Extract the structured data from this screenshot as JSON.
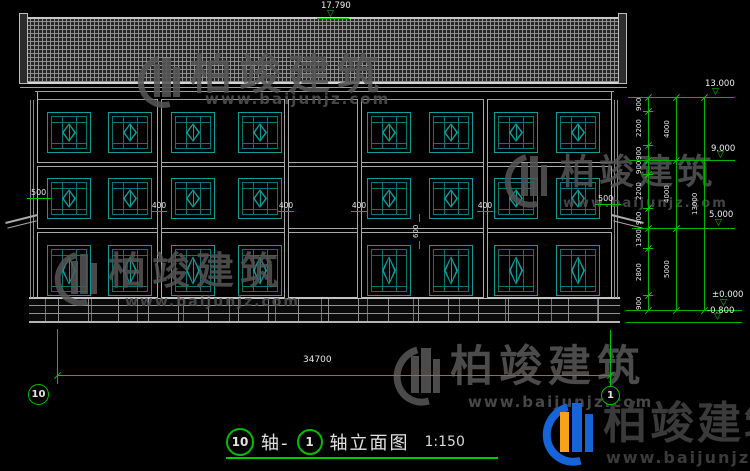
{
  "watermark": {
    "brand": "柏竣建筑",
    "url": "www.baijunjz.com"
  },
  "title": {
    "axis_start_bubble": "10",
    "axis_label_left": "轴-",
    "axis_end_bubble": "1",
    "drawing_name": "轴立面图",
    "scale": "1:150"
  },
  "axis_bubbles": {
    "left": "10",
    "right": "1"
  },
  "elevation_markers": [
    {
      "id": "ridge",
      "value": "17.790"
    },
    {
      "id": "eave",
      "value": "13.000"
    },
    {
      "id": "level-3",
      "value": "9.000"
    },
    {
      "id": "level-2",
      "value": "5.000"
    },
    {
      "id": "ground",
      "value": "±0.000"
    },
    {
      "id": "grade",
      "value": "-0.800"
    }
  ],
  "dimensions": {
    "right_inner_chain": [
      "900",
      "2200",
      "900",
      "900",
      "2200",
      "900",
      "1300",
      "2800",
      "900"
    ],
    "right_middle_chain": [
      "4000",
      "4000",
      "5000"
    ],
    "right_outer_chain": [
      "13000"
    ],
    "bottom_total_width": "34700",
    "column_width_labels": [
      "400",
      "400",
      "400",
      "400"
    ],
    "left_overhang": "500",
    "right_overhang": "500",
    "spandrel_height": "600"
  },
  "colors": {
    "dimension_green": "#00c400",
    "window_teal": "#0e9c9c",
    "outline_gray": "#b3b3b3",
    "watermark_gray": "#565656",
    "logo_blue": "#1565d8",
    "logo_orange": "#f5a31d"
  }
}
